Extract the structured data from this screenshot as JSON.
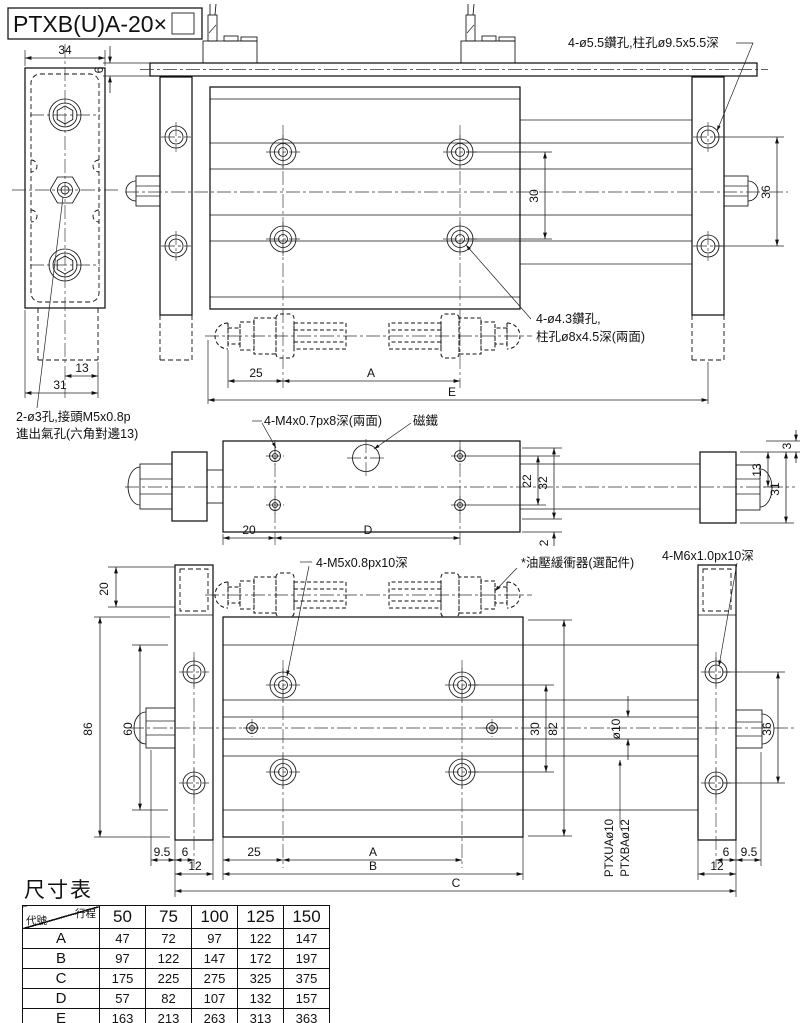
{
  "title": "PTXB(U)A-20×",
  "side_view": {
    "d34": "34",
    "d13": "13",
    "d31": "31",
    "note1": "2-ø3孔,接頭M5x0.8p",
    "note2": "進出氣孔(六角對邊13)"
  },
  "top_view": {
    "d6": "6",
    "d30": "30",
    "d36": "36",
    "d25": "25",
    "dA": "A",
    "dE": "E",
    "note_drill": "4-ø5.5鑽孔,柱孔ø9.5x5.5深",
    "note_cb1": "4-ø4.3鑽孔,",
    "note_cb2": "柱孔ø8x4.5深(兩面)"
  },
  "mid_view": {
    "d20": "20",
    "dD": "D",
    "d22": "22",
    "d32": "32",
    "d2": "2",
    "d3": "3",
    "d13": "13",
    "d31": "31",
    "note_tap": "4-M4x0.7px8深(兩面)",
    "note_magnet": "磁鐵",
    "note_m6": "4-M6x1.0px10深"
  },
  "bottom_view": {
    "d20": "20",
    "d86": "86",
    "d60": "60",
    "d30": "30",
    "d82": "82",
    "dia10": "ø10",
    "d36": "36",
    "d95l": "9.5",
    "d6l": "6",
    "d12l": "12",
    "d25": "25",
    "dA": "A",
    "dB": "B",
    "dC": "C",
    "d6r": "6",
    "d95r": "9.5",
    "d12r": "12",
    "note_m5": "4-M5x0.8px10深",
    "note_shock": "*油壓緩衝器(選配件)",
    "rod1": "PTXUAø10",
    "rod2": "PTXBAø12"
  },
  "table": {
    "title": "尺寸表",
    "corner_top": "行程",
    "corner_bottom": "代號",
    "columns": [
      "50",
      "75",
      "100",
      "125",
      "150"
    ],
    "rows": [
      {
        "label": "A",
        "values": [
          "47",
          "72",
          "97",
          "122",
          "147"
        ]
      },
      {
        "label": "B",
        "values": [
          "97",
          "122",
          "147",
          "172",
          "197"
        ]
      },
      {
        "label": "C",
        "values": [
          "175",
          "225",
          "275",
          "325",
          "375"
        ]
      },
      {
        "label": "D",
        "values": [
          "57",
          "82",
          "107",
          "132",
          "157"
        ]
      },
      {
        "label": "E",
        "values": [
          "163",
          "213",
          "263",
          "313",
          "363"
        ]
      }
    ]
  }
}
